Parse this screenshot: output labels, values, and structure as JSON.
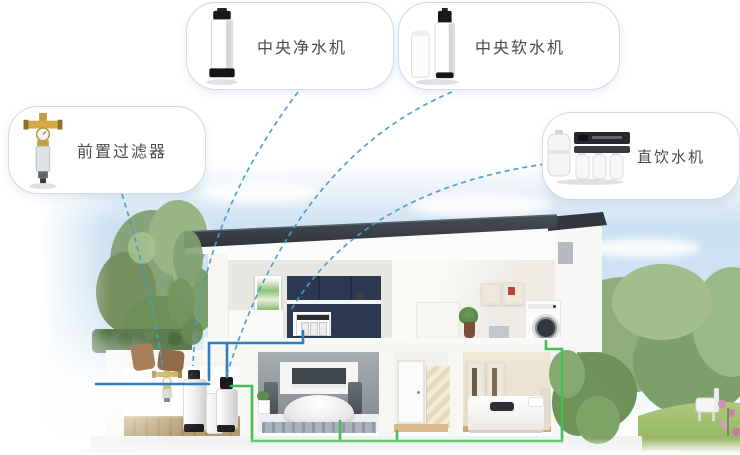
{
  "cards": [
    {
      "id": "central-water-purifier",
      "label": "中央净水机"
    },
    {
      "id": "central-water-softener",
      "label": "中央软水机"
    },
    {
      "id": "pre-filter",
      "label": "前置过滤器"
    },
    {
      "id": "direct-drinking-machine",
      "label": "直饮水机"
    }
  ],
  "scene": {
    "type": "cutaway-house-water-system-diagram",
    "equipment": [
      {
        "id": "prefilter-unit",
        "location": "basement-inlet-pipe"
      },
      {
        "id": "purifier-tank",
        "location": "basement"
      },
      {
        "id": "salt-tank",
        "location": "basement"
      },
      {
        "id": "softener-tank",
        "location": "basement"
      },
      {
        "id": "under-sink-drinking-unit",
        "location": "kitchen-cabinet"
      },
      {
        "id": "washing-machine",
        "location": "upper-floor-laundry"
      },
      {
        "id": "bathtub",
        "location": "ground-floor-bathroom"
      }
    ],
    "connections": [
      {
        "from": "pre-filter",
        "to": "prefilter-unit"
      },
      {
        "from": "central-water-purifier",
        "to": "purifier-tank"
      },
      {
        "from": "central-water-softener",
        "to": "softener-tank"
      },
      {
        "from": "direct-drinking-machine",
        "to": "under-sink-drinking-unit"
      }
    ]
  },
  "colors": {
    "connector_line": "#4a9cc7",
    "cold_water_pipe": "#2a7ec2",
    "soft_water_pipe": "#44bd57",
    "card_border": "#cddce7",
    "roof": "#3a4046",
    "tower_roof": "#31373d"
  }
}
